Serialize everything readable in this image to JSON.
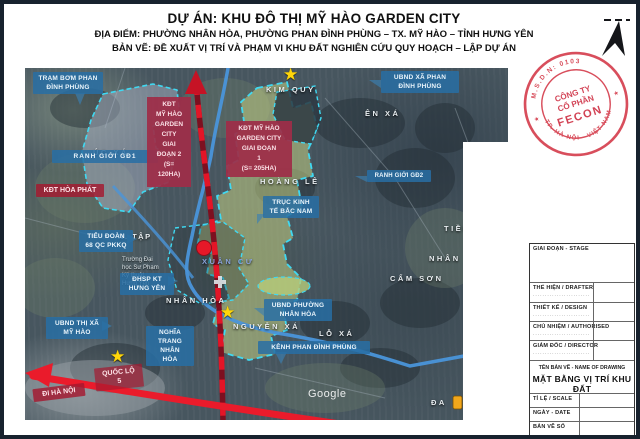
{
  "header": {
    "project": "DỰ ÁN: KHU ĐÔ THỊ MỸ HÀO GARDEN CITY",
    "location": "ĐỊA ĐIỂM: PHƯỜNG NHÂN HÒA, PHƯỜNG PHAN ĐÌNH PHÙNG – TX. MỸ HÀO – TỈNH HƯNG YÊN",
    "drawing": "BẢN VẼ: ĐỀ XUẤT VỊ TRÍ VÀ PHẠM VI KHU ĐẤT NGHIÊN CỨU QUY HOẠCH – LẬP DỰ ÁN"
  },
  "stamp": {
    "arc_top": "M.S.D.N: 0103",
    "arc_bottom": "TP. HÀ NỘI - VIỆT NAM",
    "line1": "CÔNG TY",
    "line2": "CỔ PHẦN",
    "line3": "FECON"
  },
  "map": {
    "watermark": "Google",
    "zones": {
      "phase2": "KĐT\nMỸ HÀO\nGARDEN\nCITY\nGIAI\nĐOẠN 2\n(S=\n120HA)",
      "phase1": "KĐT MỸ HÀO\nGARDEN CITY\nGIAI ĐOẠN\n1\n(S= 205HA)"
    },
    "labels": {
      "tram_bom": "TRẠM BƠM PHAN\nĐÌNH PHÙNG",
      "ranh_gd1": "RANH GIỚI GĐ1",
      "tieu_doan": "TIỂU ĐOÀN\n68 QC PKKQ",
      "dhsp": "ĐHSP KT\nHƯNG YÊN",
      "ubnd_thi_xa": "UBND THỊ XÃ\nMỸ HÀO",
      "nghia_trang": "NGHĨA\nTRANG NHÂN\nHÒA",
      "ubnd_phuong_nhan_hoa": "UBND PHƯỜNG\nNHÂN HÒA",
      "kenh_phan_dinh_phung": "KÊNH PHAN ĐÌNH PHÙNG",
      "ubnd_xa_phan_dinh_phung": "UBND XÃ PHAN\nĐÌNH PHÙNG",
      "ranh_gd2": "RANH GIỚI GĐ2",
      "truc_kinh_te": "TRỤC KINH\nTẾ BẮC NAM"
    },
    "road_labels": {
      "kdt_hoa_phat": "KĐT HÒA PHÁT",
      "quoc_lo_5": "QUỐC LỘ\n5",
      "di_ha_noi": "ĐI HÀ NỘI"
    },
    "places": {
      "kim_quy": "KIM QUY",
      "yen_xa": "ÊN XÁ",
      "uc_xa": "ÚC XÁ",
      "hoang_le": "HOÀNG LÊ",
      "xuan_cu": "XUÂN CƯ",
      "nhan_hoa": "NHÂN HÒA",
      "nguyen_xa": "NGUYỄN XÁ",
      "lo_xa": "LỖ XÁ",
      "cam_son": "CẨM SƠN",
      "nhan": "NHÂN",
      "tien": "TIỀN",
      "da": "ĐA",
      "n_tap": "N. TẬP",
      "university": "Trường Đại\nhọc Sư Phạm\nKỹ thuật\nHưng Yên"
    },
    "icons": {
      "star_marker": "★",
      "north_arrow": "north-arrow",
      "poi_marker": "orange-marker"
    },
    "colors": {
      "label_blue": "#2a6ea5",
      "label_red": "#a51930",
      "zone_yellow": "#c3d083",
      "zone_gray": "#b9c2d6",
      "boundary_cyan": "#3fd9f2",
      "road_red": "#e31527",
      "canal_blue": "#4a95da",
      "stamp_red": "#d5404f",
      "star_yellow": "#ffd60a"
    }
  },
  "titleblock": {
    "stage": "GIAI ĐOẠN - STAGE",
    "drafter": "THỂ HIỆN / DRAFTER",
    "design": "THIẾT KẾ / DESIGN",
    "authorised": "CHỦ NHIỆM / AUTHORISED",
    "director": "GIÁM ĐỐC / DIRECTOR",
    "sig_dots": "........................",
    "name_caption": "TÊN BẢN VẼ - NAME OF DRAWING",
    "name": "MẶT BẰNG VỊ TRÍ KHU ĐẤT",
    "scale": "TỈ LỆ / SCALE",
    "date": "NGÀY - DATE",
    "number": "BẢN VẼ SỐ"
  }
}
